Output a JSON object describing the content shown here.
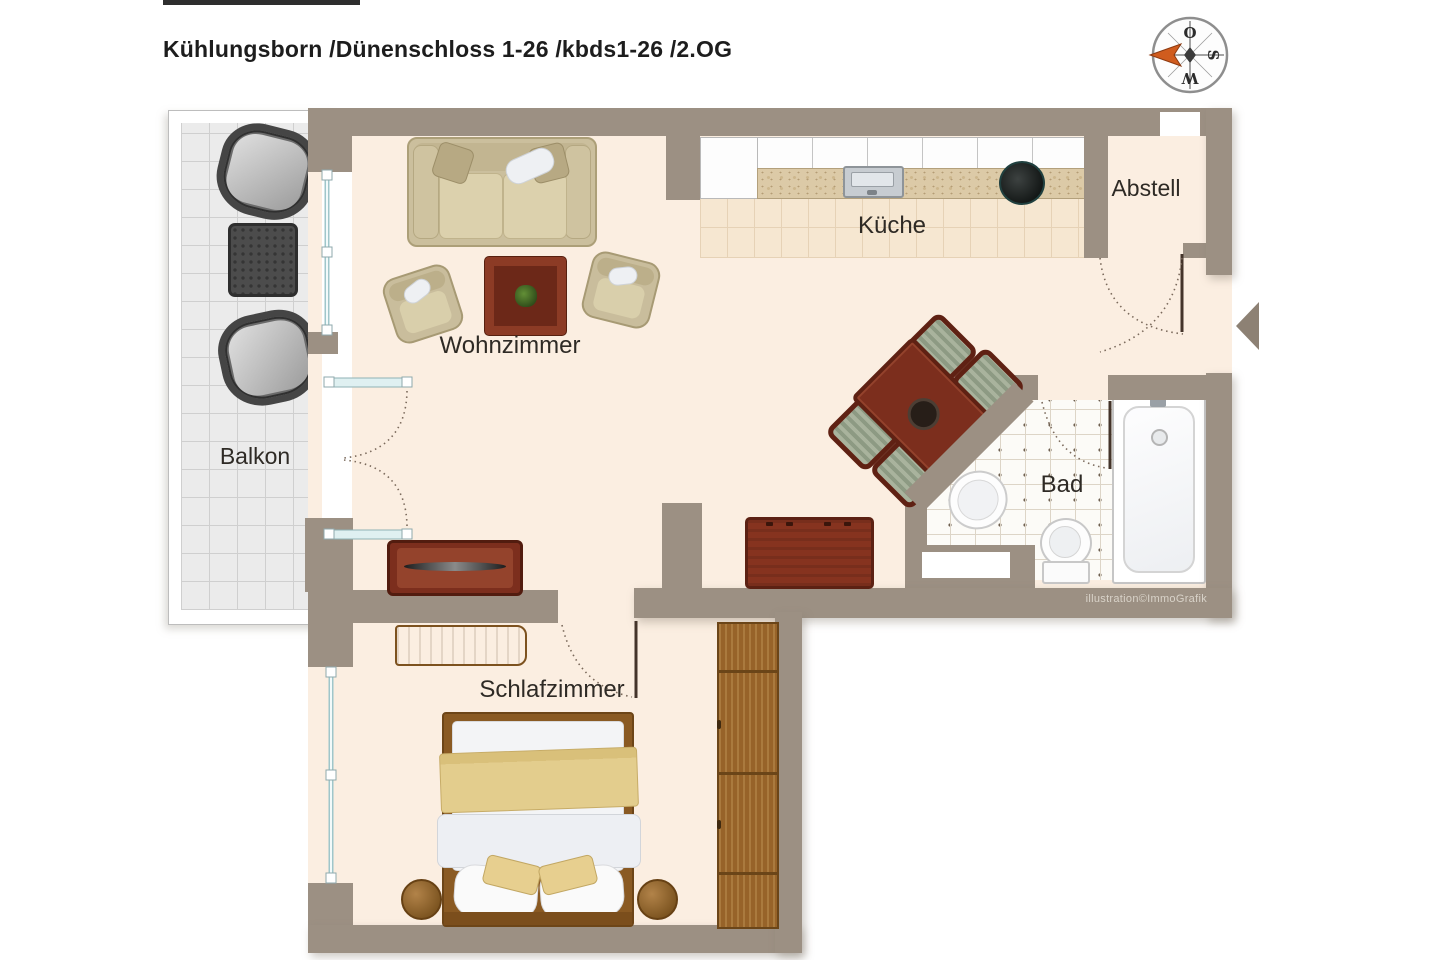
{
  "title": "Kühlungsborn /Dünenschloss 1-26 /kbds1-26 /2.OG",
  "compass": {
    "east": "O",
    "south": "S",
    "west": "W"
  },
  "rooms": {
    "living": "Wohnzimmer",
    "kitchen": "Küche",
    "storage": "Abstell",
    "balcony": "Balkon",
    "bath": "Bad",
    "bedroom": "Schlafzimmer"
  },
  "credit": "illustration©ImmoGrafik",
  "colors": {
    "wall": "#9c9083",
    "floor": "#fbeee1",
    "needle": "#d05c1e",
    "glass": "#9fc6ca",
    "wood_dark_red": "#7c2e1d"
  }
}
